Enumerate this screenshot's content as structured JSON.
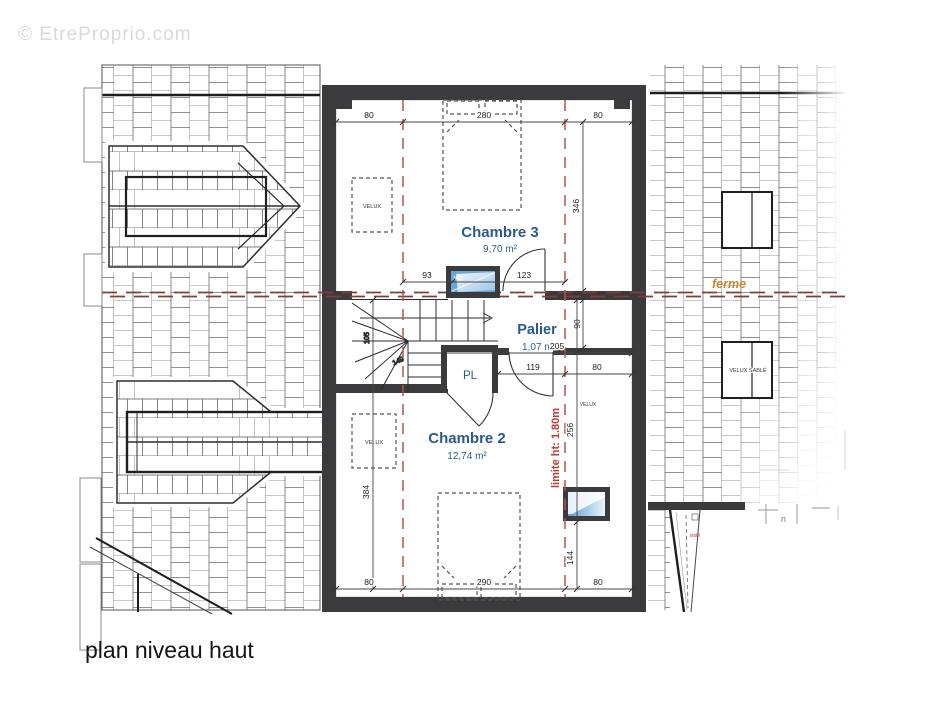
{
  "watermark": "© EtreProprio.com",
  "title": "plan niveau haut",
  "rooms": {
    "chambre3": {
      "name": "Chambre 3",
      "area": "9,70 m²"
    },
    "palier": {
      "name": "Palier",
      "area": "1,07 m²"
    },
    "chambre2": {
      "name": "Chambre 2",
      "area": "12,74 m²"
    },
    "closet": {
      "label": "PL"
    }
  },
  "annotations": {
    "ferme": "ferme",
    "limite": "limite ht: 1.80m",
    "velux": "VELUX",
    "velux_sable": "VELUX SABLÉ",
    "window_code": "3CE",
    "isole": "isolé",
    "n_mark": "n"
  },
  "dimensions": {
    "top": [
      "80",
      "280",
      "80"
    ],
    "chambre3_height": "346",
    "chambre3_bottom": [
      "93",
      "123"
    ],
    "palier_height": "90",
    "palier_width": "205",
    "palier_bottom": [
      "119",
      "80"
    ],
    "chambre2_height_left": "384",
    "chambre2_right": [
      "256",
      "144"
    ],
    "bottom": [
      "80",
      "290",
      "80"
    ],
    "stair_width": "105",
    "stair_depth": "149"
  },
  "colors": {
    "wall": "#3b3b3d",
    "room_label": "#2a5a8c",
    "limite_red": "#c03a30",
    "ferme_orange": "#c8862f",
    "ridge_dash": "#7d3f39",
    "glass_blue": "#5b9fd4"
  }
}
